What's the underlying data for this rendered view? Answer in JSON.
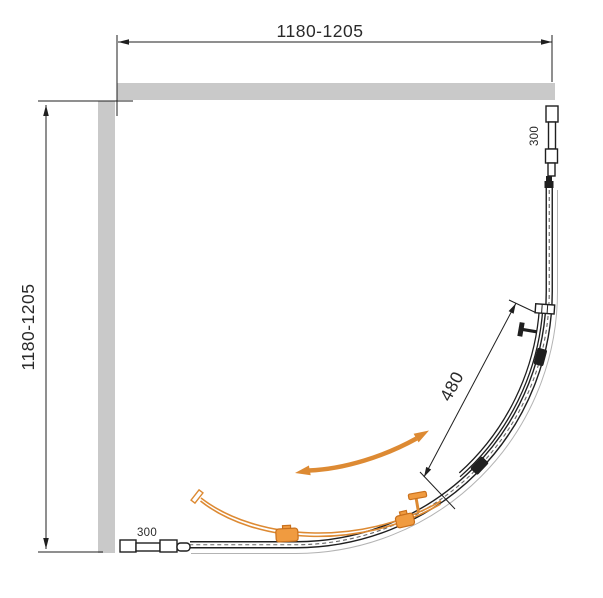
{
  "drawing": {
    "type": "shower-enclosure-quarter-round-top-view",
    "dimensions": {
      "overall_width": "1180-1205",
      "overall_depth": "1180-1205",
      "door_panel": "480",
      "fixed_segment_right": "300",
      "fixed_segment_bottom": "300"
    }
  },
  "colors": {
    "wall": "#c9c9c9",
    "line": "#1f1f1f",
    "dim": "#2a2a2a",
    "faint": "#b3b3b3",
    "orange": "#dd8a33",
    "orange_fill": "#f09b40",
    "orange_dark": "#c9701c"
  }
}
